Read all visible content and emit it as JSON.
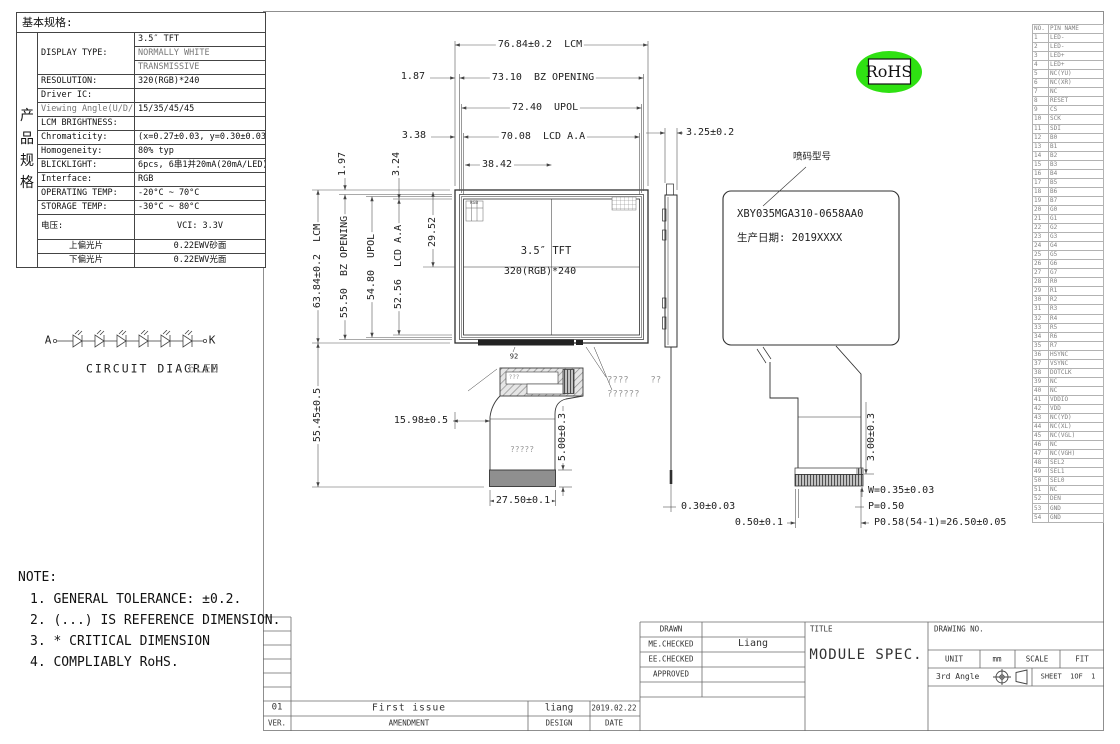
{
  "spec_table": {
    "header": "基本规格:",
    "side_label": "产\n品\n规\n格",
    "rows": {
      "display_type_label": "DISPLAY TYPE:",
      "display_type_1": "3.5″ TFT",
      "display_type_2": "NORMALLY WHITE",
      "display_type_3": "TRANSMISSIVE",
      "resolution_label": "RESOLUTION:",
      "resolution": "320(RGB)*240",
      "driver_ic_label": "Driver IC:",
      "driver_ic": "",
      "viewing_angle_label": "Viewing Angle(U/D/L/R)",
      "viewing_angle": "15/35/45/45",
      "lcm_brightness_label": "LCM BRIGHTNESS:",
      "lcm_brightness": "",
      "chromaticity_label": "Chromaticity:",
      "chromaticity": "(x=0.27±0.03, y=0.30±0.03)",
      "homogeneity_label": "Homogeneity:",
      "homogeneity": "80% typ",
      "backlight_label": "BLICKLIGHT:",
      "backlight": "6pcs, 6串1并20mA(20mA/LED)",
      "interface_label": "Interface:",
      "interface": "RGB",
      "operating_temp_label": "OPERATING TEMP:",
      "operating_temp": "-20°C ~ 70°C",
      "storage_temp_label": "STORAGE TEMP:",
      "storage_temp": "-30°C ~ 80°C",
      "voltage_label": "电压:",
      "voltage": "VCI: 3.3V",
      "top_polarizer_label": "上偏光片",
      "top_polarizer": "0.22EWV砂面",
      "bottom_polarizer_label": "下偏光片",
      "bottom_polarizer": "0.22EWV光面"
    }
  },
  "circuit": {
    "anode": "A",
    "cathode": "K",
    "caption": "CIRCUIT DIAGRAM",
    "led_count": "6LED"
  },
  "front_view": {
    "panel_type": "3.5″ TFT",
    "panel_res": "320(RGB)*240",
    "pixel_label": "RGB",
    "ref_mark": "92",
    "fpc_note_1": "????    ??",
    "fpc_note_2": "??????",
    "fpc_note_3": "?????",
    "fpc_note_4": "???"
  },
  "back_view": {
    "leader_label": "喷码型号",
    "model_no": "XBY035MGA310-0658AA0",
    "prod_date": "生产日期: 2019XXXX"
  },
  "rohs": "RoHS",
  "dims": {
    "lcm_w": "76.84±0.2  LCM",
    "bz_gap": "1.87",
    "bz_w": "73.10  BZ OPENING",
    "upol_w": "72.40  UPOL",
    "aa_gap": "3.38",
    "aa_w": "70.08  LCD A.A",
    "half_w": "38.42",
    "top_gap_bz": "1.97",
    "top_gap_aa": "3.24",
    "lcm_h": "63.84±0.2  LCM",
    "bz_h": "55.50  BZ OPENING",
    "upol_h": "54.80  UPOL",
    "aa_h": "52.56  LCD A.A",
    "half_h": "29.52",
    "fpc_len": "55.45±0.5",
    "fpc_off": "15.98±0.5",
    "stiff_h": "5.00±0.3",
    "tail_w": "27.50±0.1",
    "thickness": "3.25±0.2",
    "fpc_thk": "0.30±0.03",
    "conn_h": "3.00±0.3",
    "pad_w": "W=0.35±0.03",
    "pitch": "P=0.50",
    "pitch_total": "P0.58(54-1)=26.50±0.05",
    "conn_off": "0.50±0.1"
  },
  "pin_table": {
    "headers": {
      "no": "NO.",
      "name": "PIN NAME"
    },
    "pins": [
      {
        "no": "1",
        "name": "LED-"
      },
      {
        "no": "2",
        "name": "LED-"
      },
      {
        "no": "3",
        "name": "LED+"
      },
      {
        "no": "4",
        "name": "LED+"
      },
      {
        "no": "5",
        "name": "NC(YU)"
      },
      {
        "no": "6",
        "name": "NC(XR)"
      },
      {
        "no": "7",
        "name": "NC"
      },
      {
        "no": "8",
        "name": "RESET"
      },
      {
        "no": "9",
        "name": "CS"
      },
      {
        "no": "10",
        "name": "SCK"
      },
      {
        "no": "11",
        "name": "SDI"
      },
      {
        "no": "12",
        "name": "B0"
      },
      {
        "no": "13",
        "name": "B1"
      },
      {
        "no": "14",
        "name": "B2"
      },
      {
        "no": "15",
        "name": "B3"
      },
      {
        "no": "16",
        "name": "B4"
      },
      {
        "no": "17",
        "name": "B5"
      },
      {
        "no": "18",
        "name": "B6"
      },
      {
        "no": "19",
        "name": "B7"
      },
      {
        "no": "20",
        "name": "G0"
      },
      {
        "no": "21",
        "name": "G1"
      },
      {
        "no": "22",
        "name": "G2"
      },
      {
        "no": "23",
        "name": "G3"
      },
      {
        "no": "24",
        "name": "G4"
      },
      {
        "no": "25",
        "name": "G5"
      },
      {
        "no": "26",
        "name": "G6"
      },
      {
        "no": "27",
        "name": "G7"
      },
      {
        "no": "28",
        "name": "R0"
      },
      {
        "no": "29",
        "name": "R1"
      },
      {
        "no": "30",
        "name": "R2"
      },
      {
        "no": "31",
        "name": "R3"
      },
      {
        "no": "32",
        "name": "R4"
      },
      {
        "no": "33",
        "name": "R5"
      },
      {
        "no": "34",
        "name": "R6"
      },
      {
        "no": "35",
        "name": "R7"
      },
      {
        "no": "36",
        "name": "HSYNC"
      },
      {
        "no": "37",
        "name": "VSYNC"
      },
      {
        "no": "38",
        "name": "DOTCLK"
      },
      {
        "no": "39",
        "name": "NC"
      },
      {
        "no": "40",
        "name": "NC"
      },
      {
        "no": "41",
        "name": "VDDIO"
      },
      {
        "no": "42",
        "name": "VDD"
      },
      {
        "no": "43",
        "name": "NC(YD)"
      },
      {
        "no": "44",
        "name": "NC(XL)"
      },
      {
        "no": "45",
        "name": "NC(VGL)"
      },
      {
        "no": "46",
        "name": "NC"
      },
      {
        "no": "47",
        "name": "NC(VGH)"
      },
      {
        "no": "48",
        "name": "SEL2"
      },
      {
        "no": "49",
        "name": "SEL1"
      },
      {
        "no": "50",
        "name": "SEL0"
      },
      {
        "no": "51",
        "name": "NC"
      },
      {
        "no": "52",
        "name": "DEN"
      },
      {
        "no": "53",
        "name": "GND"
      },
      {
        "no": "54",
        "name": "GND"
      }
    ]
  },
  "notes": {
    "title": "NOTE:",
    "items": [
      "1. GENERAL TOLERANCE: ±0.2.",
      "2. (...) IS REFERENCE DIMENSION.",
      "3. * CRITICAL DIMENSION",
      "4. COMPLIABLY RoHS."
    ]
  },
  "title_block": {
    "drawn_label": "DRAWN",
    "me_checked_label": "ME.CHECKED",
    "ee_checked_label": "EE.CHECKED",
    "approved_label": "APPROVED",
    "checked_value": "Liang",
    "title_label": "TITLE",
    "title": "MODULE SPEC.",
    "drawing_no_label": "DRAWING NO.",
    "unit_label": "UNIT",
    "unit_value": "mm",
    "scale_label": "SCALE",
    "scale_value": "FIT",
    "angle_label": "3rd Angle",
    "sheet_label": "SHEET  1OF  1",
    "rev": {
      "ver": "01",
      "amendment": "First issue",
      "design": "liang",
      "date": "2019.02.22"
    },
    "rev_headers": {
      "ver": "VER.",
      "amendment": "AMENDMENT",
      "design": "DESIGN",
      "date": "DATE"
    }
  },
  "colors": {
    "rohs_green": "#2fe112",
    "line_dark": "#2f2f2f",
    "line_dim": "#555555"
  }
}
